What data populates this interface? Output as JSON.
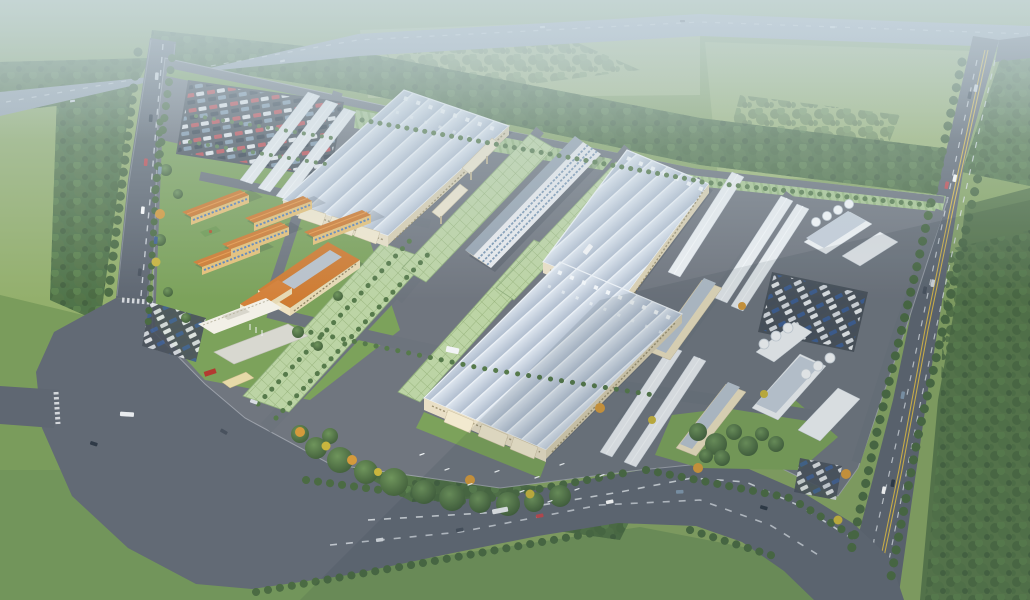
{
  "meta": {
    "description": "Aerial bird's-eye architectural rendering of a large industrial park campus surrounded by farmland, forest belts and arterial roads under hazy daylight"
  },
  "palette": {
    "field_base": "#87a564",
    "field_light": "#9cb674",
    "field_pale": "#a3b97e",
    "field_tl": "#93af6c",
    "field_dark": "#5a7a4c",
    "grass": "#7a9c5c",
    "grass_low": "#72955b",
    "lawn": "#7ca25b",
    "forest": "#4e7046",
    "forest_light": "#5d8350",
    "tree": "#4b6b43",
    "tree_line": "#567a4b",
    "tree_autumn": "#d59a3c",
    "tree_gold": "#c9b53e",
    "road": "#5f6772",
    "road_hwy": "#96a3ae",
    "intersection": "#626a75",
    "asphalt_campus": "#70767f",
    "internal_road": "#6d747d",
    "parking": "#4b535c",
    "lane_white": "#dfe4e9",
    "lane_yellow": "#d9b84a",
    "sidewalk": "#99a1aa",
    "fence": "#a7adb5",
    "grid_green": "#bcd4a5",
    "grid_line": "#9ab67f",
    "hedge": "#a9c792",
    "hedge_line": "#93b57c",
    "roof_light": "#dfe7f0",
    "roof_mid": "#b2bfd0",
    "roof_ridge": "#edf2f7",
    "vent_white": "#f2f6f9",
    "facade_cream": "#e9dfc6",
    "facade_shadow": "#d9cfb2",
    "entrance_cream": "#f2e9cf",
    "window_trim": "#8a7f5f",
    "office_wall": "#e8eaed",
    "office_roof": "#97a4b1",
    "window_blue": "#7e99b4",
    "bridge_cream": "#ece4cc",
    "small_wall": "#e9edf0",
    "small_edge": "#c6ced6",
    "small_roof": "#c3cdd8",
    "dorm_wall": "#e6c178",
    "dorm_window": "#5b83b8",
    "dorm_roof": "#cf7c33",
    "dorm_ridge": "#e89a4a",
    "canteen_skylight": "#b9c2cb",
    "court_green": "#6e9a52",
    "admin_wall": "#f2f0e7",
    "plaza": "#d8d8d0",
    "gate_wall": "#e6d9a8",
    "sign_red": "#b33a31",
    "tank": "#f4f6f8",
    "tank_edge": "#c9d2da",
    "bird": "#f4f8fa",
    "haze": "#c7d6de",
    "shadow": "rgba(35,45,58,0.20)"
  },
  "car_colors": [
    "#c04a50",
    "#e8ebee",
    "#2f3a47",
    "#8098ad",
    "#3f5f93",
    "#d9dde2",
    "#49525e",
    "#ffffff"
  ],
  "scene": {
    "environment": [
      "hazy horizon with atmospheric fade",
      "farmland fields",
      "forest belts",
      "elevated highway across the top",
      "tree-lined arterial road on the left",
      "arterial road with yellow centerline on the right",
      "wide boulevard with intersection at bottom-left"
    ],
    "campus_zones": [
      "visitor parking lot (north-west)",
      "service workshop rows (north-west)",
      "large production hall 1",
      "large production hall 2",
      "large production hall 3",
      "central multi-storey office slab with sky-bridges",
      "green lattice esplanades between halls",
      "dormitory quarter with canteen, admin building and basketball court",
      "entrance plaza with gate house and red sign",
      "eastern workshop rows and cream workshops",
      "utility plants with white storage tanks",
      "staff parking lots",
      "south-east lawn with tree clusters",
      "perimeter hedge strip along the north fence"
    ]
  }
}
